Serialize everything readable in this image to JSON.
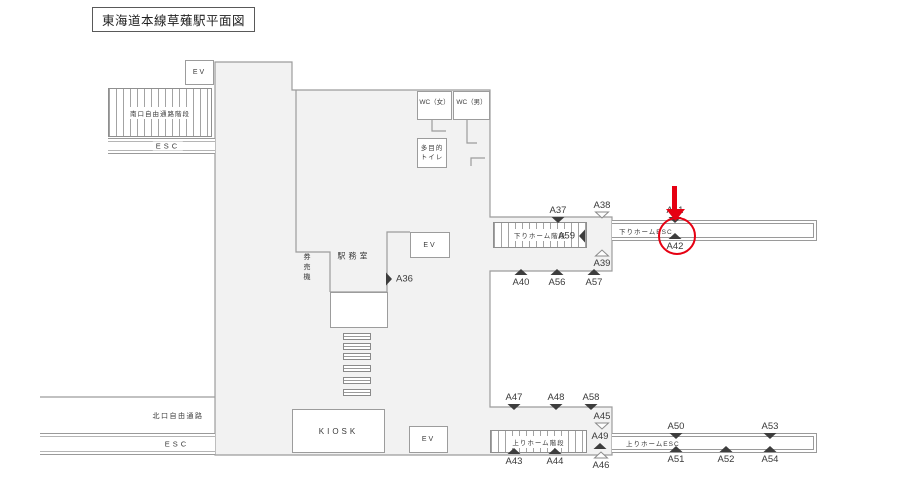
{
  "title": "東海道本線草薙駅平面図",
  "colors": {
    "building_fill": "#f2f2f2",
    "outline": "#9c9c9c",
    "ink": "#3a3a3a",
    "highlight": "#e60012"
  },
  "facilities": {
    "ev_top": "EV",
    "ev_mid": "EV",
    "ev_bottom": "EV",
    "wc_women": "WC（女）",
    "wc_men": "WC（男）",
    "multipurpose_toilet": [
      "多目的",
      "トイレ"
    ],
    "station_office": "駅務室",
    "ticket_machines": "券売機",
    "kiosk": "KIOSK"
  },
  "passages": {
    "south_corridor_stairs": "南口自由通路階段",
    "south_esc": "ESC",
    "north_corridor": "北口自由通路",
    "north_esc": "ESC",
    "down_platform_stairs": "下りホーム階段",
    "down_platform_esc": "下りホームESC",
    "up_platform_stairs": "上りホーム階段",
    "up_platform_esc": "上りホームESC"
  },
  "markers": [
    {
      "id": "A36",
      "x": 389,
      "y": 279,
      "dir": "right",
      "filled": true,
      "label_side": "right"
    },
    {
      "id": "A37",
      "x": 558,
      "y": 220,
      "dir": "down",
      "filled": true,
      "label_side": "above"
    },
    {
      "id": "A38",
      "x": 602,
      "y": 215,
      "dir": "down",
      "filled": false,
      "label_side": "above"
    },
    {
      "id": "A59",
      "x": 582,
      "y": 236,
      "dir": "left",
      "filled": true,
      "label_side": "left"
    },
    {
      "id": "A39",
      "x": 602,
      "y": 253,
      "dir": "up",
      "filled": false,
      "label_side": "below"
    },
    {
      "id": "A40",
      "x": 521,
      "y": 272,
      "dir": "up",
      "filled": true,
      "label_side": "below"
    },
    {
      "id": "A56",
      "x": 557,
      "y": 272,
      "dir": "up",
      "filled": true,
      "label_side": "below"
    },
    {
      "id": "A57",
      "x": 594,
      "y": 272,
      "dir": "up",
      "filled": true,
      "label_side": "below"
    },
    {
      "id": "A41",
      "x": 675,
      "y": 220,
      "dir": "down",
      "filled": true,
      "label_side": "above"
    },
    {
      "id": "A42",
      "x": 675,
      "y": 236,
      "dir": "up",
      "filled": true,
      "label_side": "below"
    },
    {
      "id": "A47",
      "x": 514,
      "y": 407,
      "dir": "down",
      "filled": true,
      "label_side": "above"
    },
    {
      "id": "A48",
      "x": 556,
      "y": 407,
      "dir": "down",
      "filled": true,
      "label_side": "above"
    },
    {
      "id": "A58",
      "x": 591,
      "y": 407,
      "dir": "down",
      "filled": true,
      "label_side": "above"
    },
    {
      "id": "A45",
      "x": 602,
      "y": 426,
      "dir": "down",
      "filled": false,
      "label_side": "above"
    },
    {
      "id": "A49",
      "x": 600,
      "y": 446,
      "dir": "up",
      "filled": true,
      "label_side": "above"
    },
    {
      "id": "A46",
      "x": 601,
      "y": 455,
      "dir": "up",
      "filled": false,
      "label_side": "below"
    },
    {
      "id": "A43",
      "x": 514,
      "y": 451,
      "dir": "up",
      "filled": true,
      "label_side": "below"
    },
    {
      "id": "A44",
      "x": 555,
      "y": 451,
      "dir": "up",
      "filled": true,
      "label_side": "below"
    },
    {
      "id": "A50",
      "x": 676,
      "y": 436,
      "dir": "down",
      "filled": true,
      "label_side": "above"
    },
    {
      "id": "A53",
      "x": 770,
      "y": 436,
      "dir": "down",
      "filled": true,
      "label_side": "above"
    },
    {
      "id": "A51",
      "x": 676,
      "y": 449,
      "dir": "up",
      "filled": true,
      "label_side": "below"
    },
    {
      "id": "A52",
      "x": 726,
      "y": 449,
      "dir": "up",
      "filled": true,
      "label_side": "below"
    },
    {
      "id": "A54",
      "x": 770,
      "y": 449,
      "dir": "up",
      "filled": true,
      "label_side": "below"
    }
  ],
  "highlight_annotation": {
    "shapes": [
      "red-arrow-down",
      "red-circle"
    ],
    "target_marker": "A42"
  }
}
